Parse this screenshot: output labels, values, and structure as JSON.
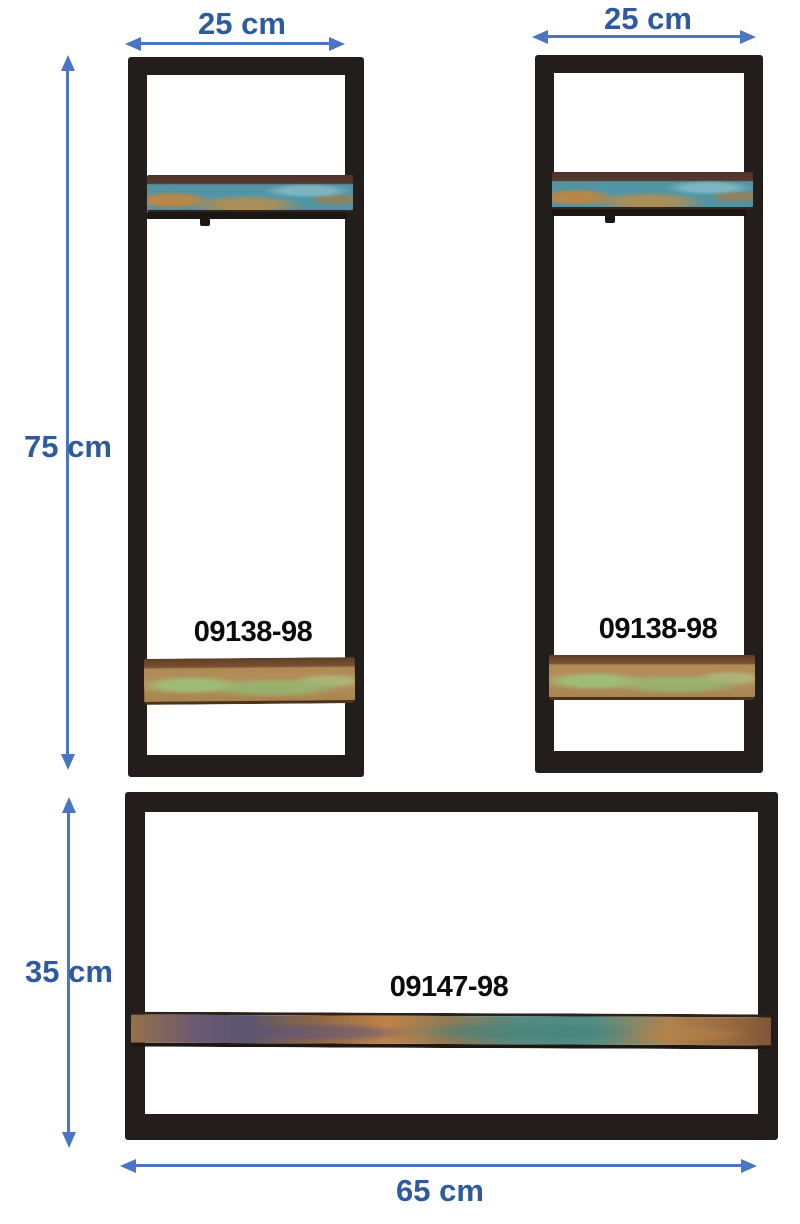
{
  "colors": {
    "arrow_blue": "#4a74c4",
    "dimension_text_blue": "#2e5b9e",
    "frame_black": "#231e1b",
    "product_code_black": "#0b0b0b",
    "background": "#ffffff"
  },
  "dimension_labels": {
    "left_unit_width": "25 cm",
    "right_unit_width": "25 cm",
    "tall_units_height": "75 cm",
    "wide_unit_height": "35 cm",
    "wide_unit_width": "65 cm"
  },
  "product_codes": {
    "tall_unit_left": "09138-98",
    "tall_unit_right": "09138-98",
    "wide_unit": "09147-98"
  }
}
